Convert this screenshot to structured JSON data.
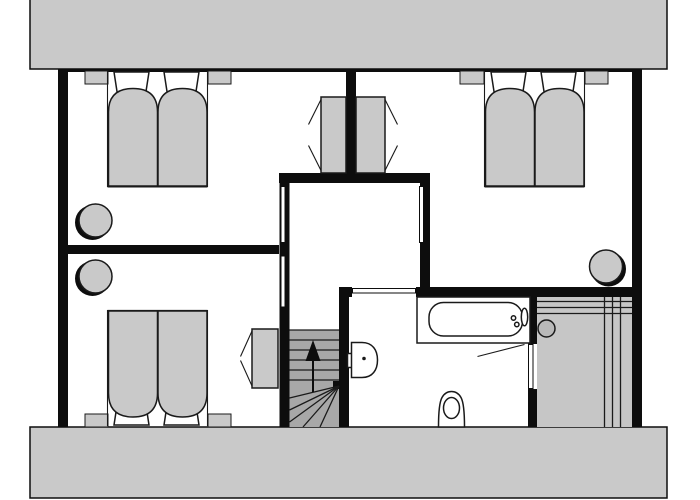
{
  "document": {
    "type": "architectural floor plan, top-down view, no text labels",
    "floor_hint": "attic storey between two sloped-roof zones (gray bands top and bottom)"
  },
  "colors": {
    "wall": "#0d0d0d",
    "floor": "#ffffff",
    "roof_band": "#c9c9c9",
    "furniture": "#c9c9c9",
    "furniture_outline": "#1a1a1a",
    "stairs": "#a8a8a8",
    "sauna_floor": "#c6c6c6",
    "heater": "#b9b9b9"
  },
  "rooms": [
    {
      "id": "bedroom-upper-left",
      "fixtures": [
        "double bed with two duvets and pillows",
        "2 nightstands",
        "wardrobe with open-door marks",
        "round chair"
      ]
    },
    {
      "id": "bedroom-lower-left",
      "fixtures": [
        "double bed with two duvets and pillows",
        "2 nightstands",
        "wardrobe with open-door marks",
        "round chair"
      ]
    },
    {
      "id": "bedroom-right",
      "fixtures": [
        "double bed with two duvets and pillows",
        "2 nightstands",
        "wardrobe with open-door marks",
        "round chair"
      ]
    },
    {
      "id": "hallway-landing",
      "fixtures": [
        "sliding/parallel door leaves to bedrooms and bathroom"
      ]
    },
    {
      "id": "staircase",
      "fixtures": [
        "6 straight treads",
        "5 winder treads",
        "up direction arrow"
      ]
    },
    {
      "id": "bathroom",
      "fixtures": [
        "bathtub with taps in platform",
        "washbasin with drain dot",
        "toilet"
      ]
    },
    {
      "id": "sauna",
      "fixtures": [
        "bench lines top and right",
        "round sauna heater",
        "door opening into bathroom with swing line"
      ]
    }
  ],
  "stairs": {
    "direction_arrow": "up",
    "straight_treads": 6,
    "winder_treads": 5
  }
}
